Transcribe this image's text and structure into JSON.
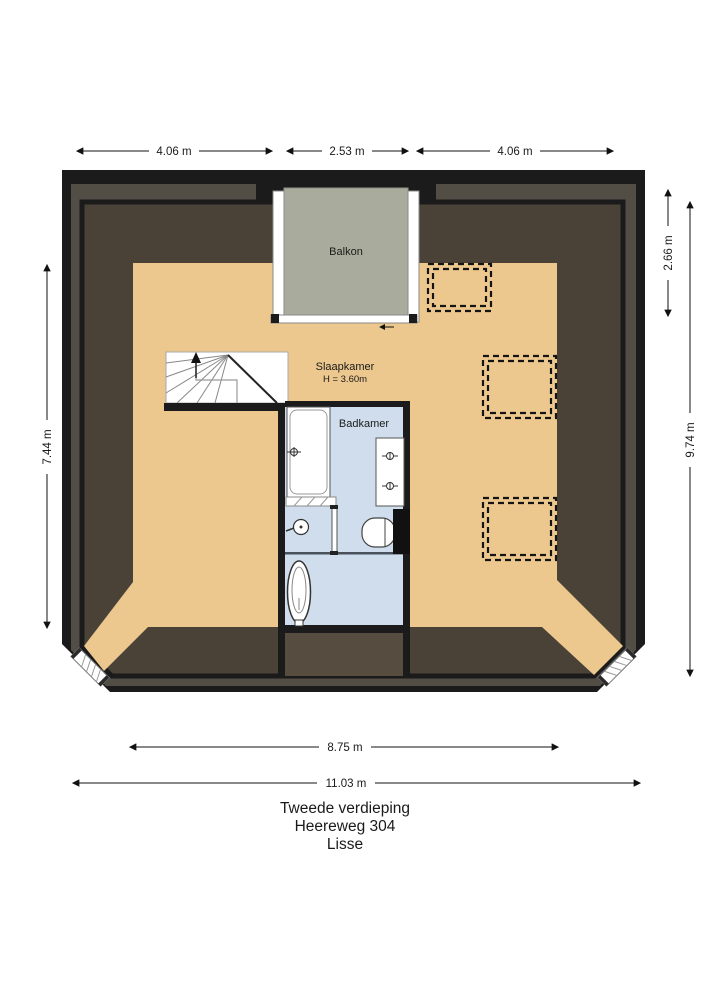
{
  "plan": {
    "rooms": {
      "balkon": {
        "label": "Balkon"
      },
      "slaapkamer": {
        "label": "Slaapkamer",
        "height_note": "H = 3.60m"
      },
      "badkamer": {
        "label": "Badkamer"
      }
    },
    "dimensions": {
      "top_left": "4.06 m",
      "top_center": "2.53 m",
      "top_right": "4.06 m",
      "left_height": "7.44 m",
      "right_balcony_height": "2.66 m",
      "right_total_height": "9.74 m",
      "bottom_inner_width": "8.75 m",
      "bottom_total_width": "11.03 m"
    },
    "title": {
      "floor": "Tweede verdieping",
      "street": "Heereweg 304",
      "city": "Lisse"
    },
    "fixtures": [
      "staircase",
      "bathtub",
      "vanity-with-two-taps",
      "shower",
      "toilet",
      "pedestal-basin",
      "skylight",
      "skylight",
      "skylight",
      "corner-window",
      "corner-window"
    ],
    "colors": {
      "wall": "#1b1b1b",
      "wall_stripe": "#524d45",
      "attic_floor": "#4a4237",
      "room_floor": "#ecc88e",
      "balcony_floor": "#a9ac9d",
      "bathroom_floor": "#cfdded",
      "center_void": "#564c40"
    }
  }
}
